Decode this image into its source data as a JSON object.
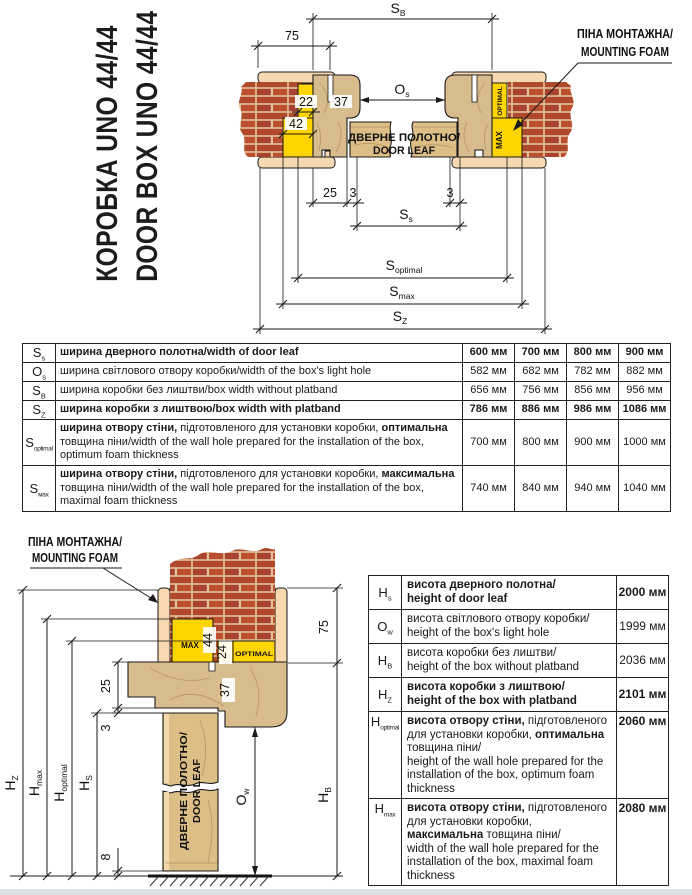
{
  "title": {
    "line1": "КОРОБКА UNO 44/44",
    "line2": "DOOR BOX UNO 44/44"
  },
  "colors": {
    "foam_yellow": "#FFD403",
    "brick": "#B04A2C",
    "mortar": "#E3C19A",
    "wood": "#D9BC8E",
    "platband": "#F7D8B0"
  },
  "drawing_top": {
    "foam_callout": [
      "ПІНА МОНТАЖНА/",
      "MOUNTING FOAM"
    ],
    "door_leaf": [
      "ДВЕРНЕ ПОЛОТНО/",
      "DOOR LEAF"
    ],
    "labels": {
      "optimal": "OPTIMAL",
      "max": "MAX"
    },
    "dims": {
      "sb": {
        "m": "S",
        "sub": "B"
      },
      "os": {
        "m": "O",
        "sub": "s"
      },
      "ss": {
        "m": "S",
        "sub": "s"
      },
      "sopt": {
        "m": "S",
        "sub": "optimal"
      },
      "smax": {
        "m": "S",
        "sub": "max"
      },
      "sz": {
        "m": "S",
        "sub": "Z"
      },
      "d75": "75",
      "d22": "22",
      "d42": "42",
      "d37": "37",
      "d25": "25",
      "d3l": "3",
      "d3r": "3"
    }
  },
  "drawing_bottom": {
    "foam_callout": [
      "ПІНА МОНТАЖНА/",
      "MOUNTING FOAM"
    ],
    "door_leaf": [
      "ДВЕРНЕ ПОЛОТНО/",
      "DOOR LEAF"
    ],
    "labels": {
      "optimal": "OPTIMAL",
      "max": "MAX"
    },
    "dims": {
      "hz": {
        "m": "H",
        "sub": "Z"
      },
      "hmax": {
        "m": "H",
        "sub": "max"
      },
      "hopt": {
        "m": "H",
        "sub": "optimal"
      },
      "hs": {
        "m": "H",
        "sub": "S"
      },
      "ow": {
        "m": "O",
        "sub": "w"
      },
      "hb": {
        "m": "H",
        "sub": "B"
      },
      "d75": "75",
      "d44": "44",
      "d24": "24",
      "d25": "25",
      "d37": "37",
      "d3": "3",
      "d8": "8"
    }
  },
  "table_width": {
    "rows": [
      {
        "sym": "S",
        "sub": "s",
        "b1": "ширина дверного полотна/width of door leaf",
        "r1": "",
        "b2": "",
        "r2": "",
        "v": [
          "600 мм",
          "700 мм",
          "800 мм",
          "900 мм"
        ]
      },
      {
        "sym": "O",
        "sub": "s",
        "b1": "",
        "r1": "ширина світлового отвору коробки/width of the box's light hole",
        "b2": "",
        "r2": "",
        "v": [
          "582 мм",
          "682 мм",
          "782 мм",
          "882 мм"
        ]
      },
      {
        "sym": "S",
        "sub": "B",
        "b1": "",
        "r1": "ширина коробки без лиштви/box width without platband",
        "b2": "",
        "r2": "",
        "v": [
          "656 мм",
          "756 мм",
          "856 мм",
          "956 мм"
        ]
      },
      {
        "sym": "S",
        "sub": "Z",
        "b1": "ширина коробки з лиштвою/box width with platband",
        "r1": "",
        "b2": "",
        "r2": "",
        "v": [
          "786 мм",
          "886 мм",
          "986 мм",
          "1086 мм"
        ]
      },
      {
        "sym": "S",
        "sub": "optimal",
        "b1": "ширина отвору стіни,",
        "r1": " підготовленого для установки коробки, ",
        "b2": "оптимальна",
        "r2": " товщина піни/width of the wall hole prepared for the installation of the box, optimum foam thickness",
        "v": [
          "700 мм",
          "800 мм",
          "900 мм",
          "1000 мм"
        ]
      },
      {
        "sym": "S",
        "sub": "мах",
        "b1": "ширина отвору стіни,",
        "r1": " підготовленого для установки коробки, ",
        "b2": "максимальна",
        "r2": " товщина піни/width of the wall hole prepared for the installation of the box, maximal foam thickness",
        "v": [
          "740 мм",
          "840 мм",
          "940 мм",
          "1040 мм"
        ]
      }
    ]
  },
  "table_height": {
    "rows": [
      {
        "sym": "H",
        "sub": "s",
        "b1": "висота дверного полотна/\nheight of door leaf",
        "r1": "",
        "b2": "",
        "r2": "",
        "val": "2000 мм"
      },
      {
        "sym": "O",
        "sub": "w",
        "b1": "",
        "r1": "висота світлового отвору коробки/\nheight of the box's light hole",
        "b2": "",
        "r2": "",
        "val": "1999 мм"
      },
      {
        "sym": "H",
        "sub": "B",
        "b1": "",
        "r1": "висота коробки без лиштви/\nheight of the box without platband",
        "b2": "",
        "r2": "",
        "val": "2036 мм"
      },
      {
        "sym": "H",
        "sub": "Z",
        "b1": "висота коробки з лиштвою/\nheight of the box with platband",
        "r1": "",
        "b2": "",
        "r2": "",
        "val": "2101 мм"
      },
      {
        "sym": "H",
        "sub": "optimal",
        "b1": "висота отвору стіни,",
        "r1": " підготовленого для установки коробки, ",
        "b2": "оптимальна",
        "r2": " товщина піни/\nheight of the wall hole prepared for the installation of the box, optimum foam thickness",
        "val": "2060 мм"
      },
      {
        "sym": "H",
        "sub": "max",
        "b1": "висота отвору стіни,",
        "r1": " підготовленого для установки коробки, ",
        "b2": "максимальна",
        "r2": " товщина піни/\nwidth of the wall hole prepared for the installation of the box, maximal foam thickness",
        "val": "2080 мм"
      }
    ]
  }
}
